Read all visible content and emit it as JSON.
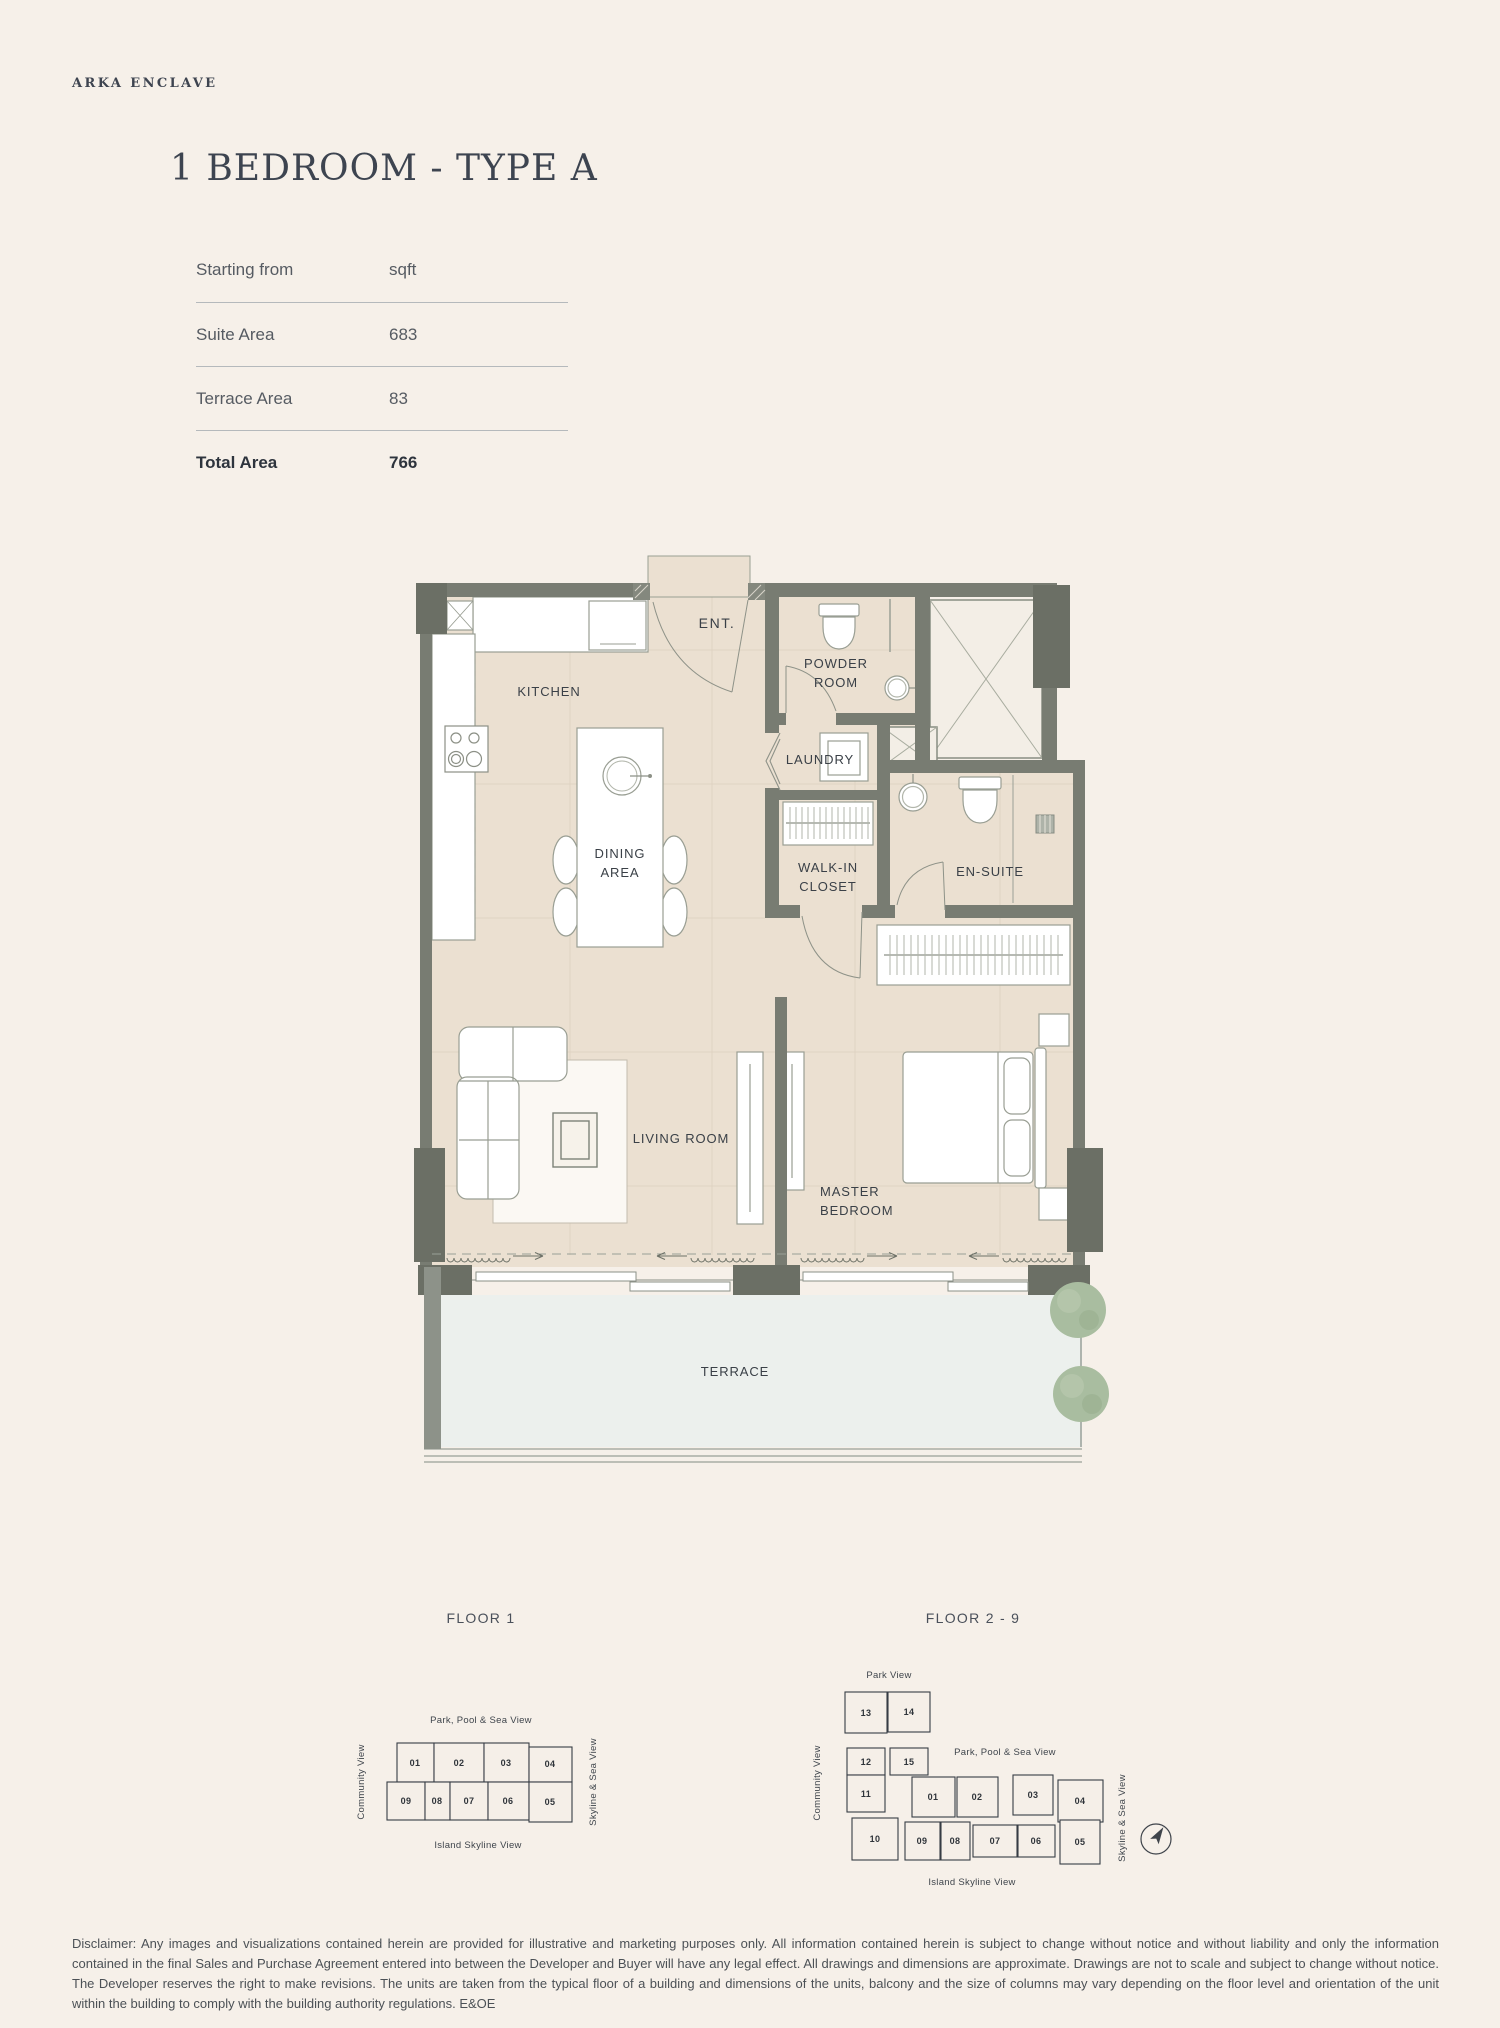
{
  "brand": "ARKA ENCLAVE",
  "title": "1 BEDROOM - TYPE A",
  "area_table": {
    "header_label": "Starting from",
    "header_unit": "sqft",
    "rows": [
      {
        "label": "Suite Area",
        "value": "683"
      },
      {
        "label": "Terrace Area",
        "value": "83"
      }
    ],
    "total_label": "Total Area",
    "total_value": "766"
  },
  "plan": {
    "labels": {
      "kitchen": "KITCHEN",
      "ent": "ENT.",
      "powder_1": "POWDER",
      "powder_2": "ROOM",
      "laundry": "LAUNDRY",
      "dining_1": "DINING",
      "dining_2": "AREA",
      "walkin_1": "WALK-IN",
      "walkin_2": "CLOSET",
      "ensuite": "EN-SUITE",
      "living": "LIVING ROOM",
      "master_1": "MASTER",
      "master_2": "BEDROOM",
      "terrace": "TERRACE"
    }
  },
  "keyplans": {
    "floor1": {
      "title": "FLOOR 1",
      "view_top": "Park, Pool & Sea View",
      "view_left": "Community View",
      "view_right": "Skyline & Sea View",
      "view_bottom": "Island Skyline View",
      "highlighted_unit": "08",
      "units": {
        "u01": "01",
        "u02": "02",
        "u03": "03",
        "u04": "04",
        "u05": "05",
        "u06": "06",
        "u07": "07",
        "u08": "08",
        "u09": "09"
      }
    },
    "floor29": {
      "title": "FLOOR 2 - 9",
      "view_top": "Park View",
      "view_left": "Community View",
      "view_mid": "Park, Pool & Sea View",
      "view_right": "Skyline & Sea View",
      "view_bottom": "Island Skyline View",
      "highlighted_unit": "08",
      "units": {
        "u01": "01",
        "u02": "02",
        "u03": "03",
        "u04": "04",
        "u05": "05",
        "u06": "06",
        "u07": "07",
        "u08": "08",
        "u09": "09",
        "u10": "10",
        "u11": "11",
        "u12": "12",
        "u13": "13",
        "u14": "14",
        "u15": "15"
      }
    }
  },
  "colors": {
    "background": "#f6f0e9",
    "floor_fill": "#ebe0d1",
    "wall": "#787c72",
    "wall_dark": "#6b6f65",
    "terrace_fill": "#ecf0ed",
    "unit_highlight": "#c7c3bb",
    "tree": "#a9bda0",
    "text_dark": "#3b4149",
    "text_muted": "#4c5156"
  },
  "disclaimer": "Disclaimer: Any images and visualizations contained herein are provided for illustrative and marketing purposes only. All information contained herein is subject to change without notice and without liability and only the information contained in the final Sales and Purchase Agreement entered into between the Developer and Buyer will have any legal effect. All drawings and dimensions are approximate. Drawings are not to scale and subject to change without notice. The Developer reserves the right to make revisions. The units are taken from the typical floor of a building and dimensions of the units, balcony and the size of columns may vary depending on the floor level and orientation of the unit within the building to comply with the building authority regulations. E&OE"
}
